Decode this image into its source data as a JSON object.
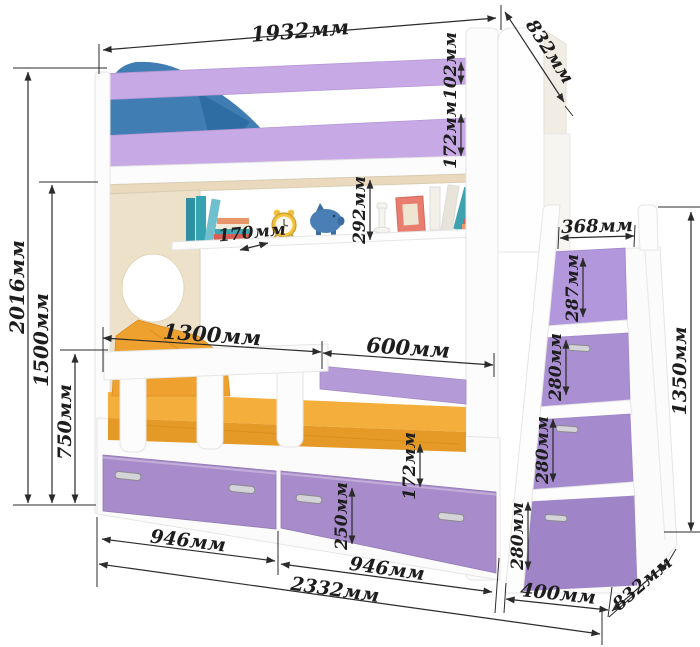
{
  "dims": {
    "bed_length_top": "1932мм",
    "bed_depth_top": "832мм",
    "top_rail_height": "102мм",
    "upper_rail_height": "172мм",
    "total_height": "2016мм",
    "upper_bunk_height": "1500мм",
    "lower_section_height": "750мм",
    "shelf_depth": "170мм",
    "shelf_space_height": "292мм",
    "mattress_left_length": "1300мм",
    "mattress_right_length": "600мм",
    "stairs_top_depth": "368мм",
    "step_1_height": "287мм",
    "step_2_height": "280мм",
    "step_3_height": "280мм",
    "step_4_height": "280мм",
    "stairs_height": "1350мм",
    "base_panel_height": "172мм",
    "drawer_height": "250мм",
    "drawer_1_width": "946мм",
    "drawer_2_width": "946мм",
    "total_length": "2332мм",
    "stairs_width": "400мм",
    "bed_depth_bottom": "832мм"
  },
  "colors": {
    "rail_purple": "#c7a9e6",
    "drawer_purple": "#a78bca",
    "step_purple_1": "#b297dd",
    "step_purple_2": "#ab8fd3",
    "step_purple_3": "#a58ace",
    "step_purple_4": "#a084c8",
    "lower_back_rail": "#b59ad8",
    "mattress_orange": "#e59a28",
    "mattress_top_orange": "#f4ae3c",
    "pillow_orange": "#efa12f",
    "pillow_blue": "#3f7db3",
    "panel_cream": "#eee1c9",
    "panel_white": "#fcfcfc",
    "dimension_line": "#2b2b2b"
  }
}
